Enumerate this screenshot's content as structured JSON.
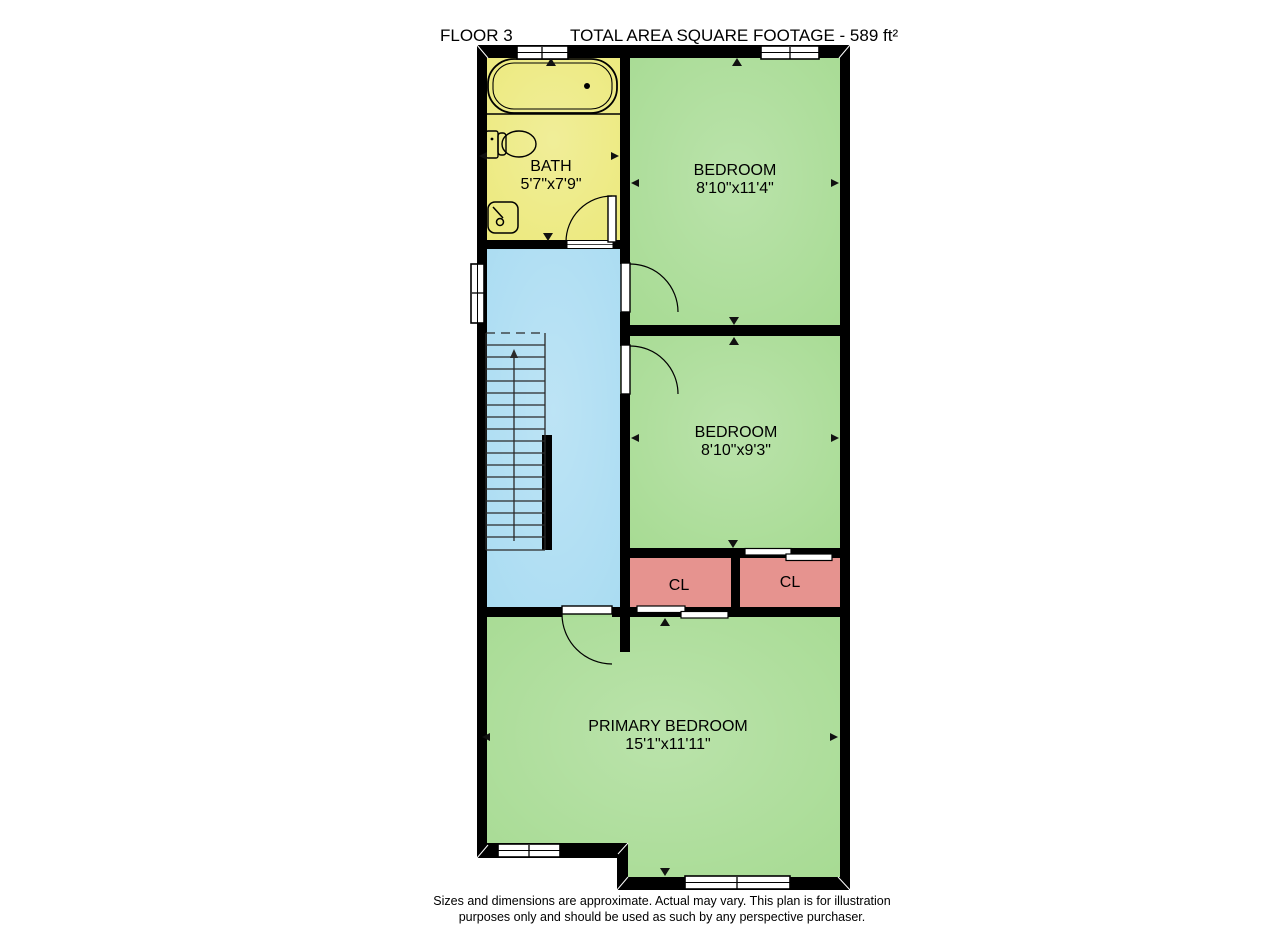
{
  "header": {
    "floor_label": "FLOOR 3",
    "total_area_label": "TOTAL AREA SQUARE FOOTAGE - 589 ft²"
  },
  "rooms": {
    "bath": {
      "name": "BATH",
      "dimensions": "5'7\"x7'9\""
    },
    "bedroom_top": {
      "name": "BEDROOM",
      "dimensions": "8'10\"x11'4\""
    },
    "bedroom_middle": {
      "name": "BEDROOM",
      "dimensions": "8'10\"x9'3\""
    },
    "closet_left": {
      "name": "CL"
    },
    "closet_right": {
      "name": "CL"
    },
    "primary_bedroom": {
      "name": "PRIMARY BEDROOM",
      "dimensions": "15'1\"x11'11\""
    }
  },
  "footer": {
    "line1": "Sizes and dimensions are approximate. Actual may vary. This plan is for illustration",
    "line2": "purposes only and should be used as such by any perspective purchaser."
  },
  "colors": {
    "bath": "#ece97c",
    "bedroom": "#a7db93",
    "hall": "#aadcf2",
    "closet": "#e6938f",
    "wall": "#000000",
    "window": "#ffffff",
    "background": "#ffffff",
    "text": "#000000"
  }
}
